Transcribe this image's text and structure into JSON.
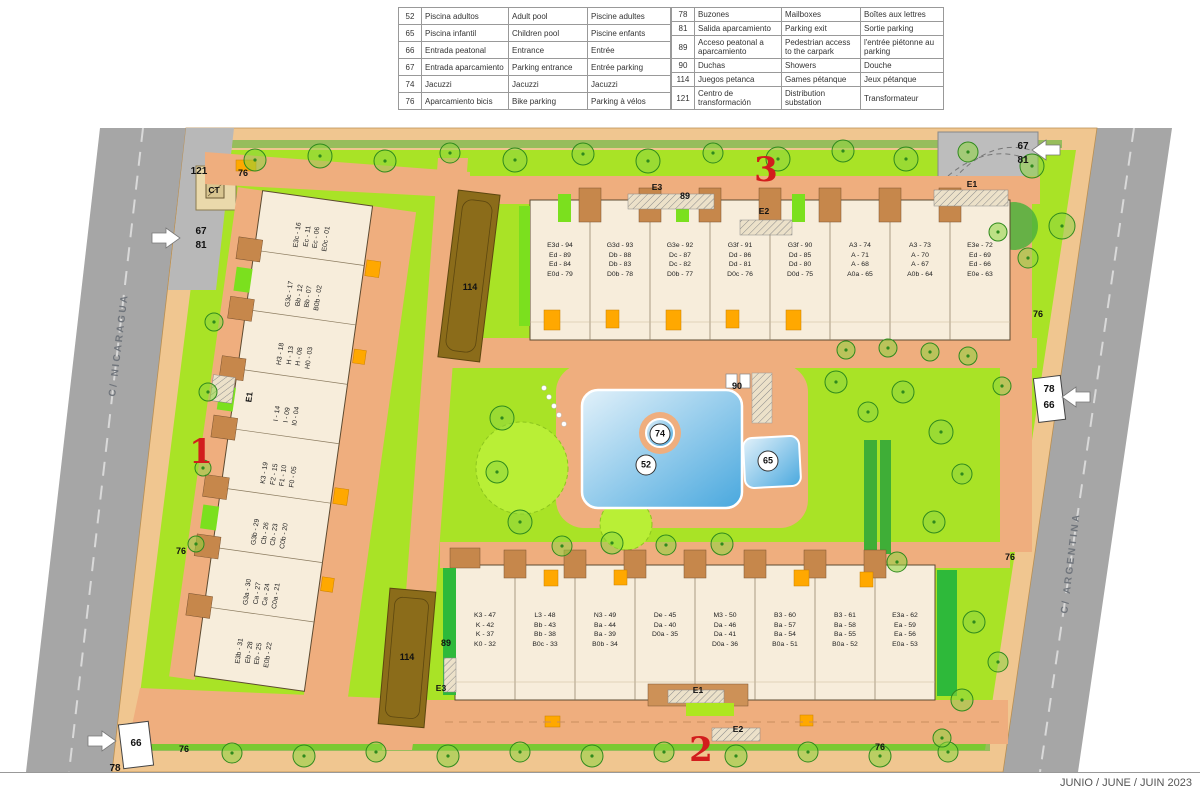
{
  "legend": {
    "rows_left": [
      {
        "num": "52",
        "es": "Piscina adultos",
        "en": "Adult pool",
        "fr": "Piscine adultes"
      },
      {
        "num": "65",
        "es": "Piscina infantil",
        "en": "Children pool",
        "fr": "Piscine enfants"
      },
      {
        "num": "66",
        "es": "Entrada peatonal",
        "en": "Entrance",
        "fr": "Entrée"
      },
      {
        "num": "67",
        "es": "Entrada aparcamiento",
        "en": "Parking entrance",
        "fr": "Entrée parking"
      },
      {
        "num": "74",
        "es": "Jacuzzi",
        "en": "Jacuzzi",
        "fr": "Jacuzzi"
      },
      {
        "num": "76",
        "es": "Aparcamiento bicis",
        "en": "Bike parking",
        "fr": "Parking à vélos"
      }
    ],
    "rows_right": [
      {
        "num": "78",
        "es": "Buzones",
        "en": "Mailboxes",
        "fr": "Boîtes aux lettres"
      },
      {
        "num": "81",
        "es": "Salida aparcamiento",
        "en": "Parking exit",
        "fr": "Sortie parking"
      },
      {
        "num": "89",
        "es": "Acceso peatonal a aparcamiento",
        "en": "Pedestrian access to the carpark",
        "fr": "l'entrée piétonne au parking"
      },
      {
        "num": "90",
        "es": "Duchas",
        "en": "Showers",
        "fr": "Douche"
      },
      {
        "num": "114",
        "es": "Juegos petanca",
        "en": "Games pétanque",
        "fr": "Jeux pétanque"
      },
      {
        "num": "121",
        "es": "Centro de transformación",
        "en": "Distribution substation",
        "fr": "Transformateur"
      }
    ]
  },
  "plan": {
    "streets": {
      "left": "C/ NICARAGUA",
      "right": "C/ ARGENTINA"
    },
    "date_stamp": "JUNIO / JUNE / JUIN 2023",
    "labels": {
      "n52": "52",
      "n65": "65",
      "n66": "66",
      "n67": "67",
      "n74": "74",
      "n76": "76",
      "n78": "78",
      "n81": "81",
      "n89": "89",
      "n90": "90",
      "n114": "114",
      "n121": "121",
      "ct": "CT",
      "e1": "E1",
      "e2": "E2",
      "e3": "E3",
      "block1": "1",
      "block2": "2",
      "block3": "3"
    },
    "buildings": {
      "b1": {
        "units": [
          {
            "l1": "E3c - 16",
            "l2": "Ec - 11",
            "l3": "Ec - 06",
            "l4": "E0c - 01"
          },
          {
            "l1": "G3c - 17",
            "l2": "Bb - 12",
            "l3": "Bb - 07",
            "l4": "B0b - 02"
          },
          {
            "l1": "H3 - 18",
            "l2": "H - 13",
            "l3": "H - 08",
            "l4": "H0 - 03"
          },
          {
            "l1": "I - 14",
            "l2": "I - 09",
            "l3": "I0 - 04"
          },
          {
            "l1": "K3 - 19",
            "l2": "F2 - 15",
            "l3": "F1 - 10",
            "l4": "F0 - 05"
          },
          {
            "l1": "G3b - 29",
            "l2": "Cb - 26",
            "l3": "Cb - 23",
            "l4": "C0b - 20"
          },
          {
            "l1": "G3a - 30",
            "l2": "Ca - 27",
            "l3": "Ca - 24",
            "l4": "C0a - 21"
          },
          {
            "l1": "E3b - 31",
            "l2": "Eb - 28",
            "l3": "Eb - 25",
            "l4": "E0b - 22"
          }
        ]
      },
      "b2": {
        "units": [
          {
            "l1": "K3 - 47",
            "l2": "K - 42",
            "l3": "K - 37",
            "l4": "K0 - 32"
          },
          {
            "l1": "L3 - 48",
            "l2": "Bb - 43",
            "l3": "Bb - 38",
            "l4": "B0c - 33"
          },
          {
            "l1": "N3 - 49",
            "l2": "Ba - 44",
            "l3": "Ba - 39",
            "l4": "B0b - 34"
          },
          {
            "l1": "De - 45",
            "l2": "Da - 40",
            "l3": "D0a - 35"
          },
          {
            "l1": "M3 - 50",
            "l2": "Da - 46",
            "l3": "Da - 41",
            "l4": "D0a - 36"
          },
          {
            "l1": "B3 - 60",
            "l2": "Ba - 57",
            "l3": "Ba - 54",
            "l4": "B0a - 51"
          },
          {
            "l1": "B3 - 61",
            "l2": "Ba - 58",
            "l3": "Ba - 55",
            "l4": "B0a - 52"
          },
          {
            "l1": "E3a - 62",
            "l2": "Ea - 59",
            "l3": "Ea - 56",
            "l4": "E0a - 53"
          }
        ]
      },
      "b3": {
        "units": [
          {
            "l1": "E3d - 94",
            "l2": "Ed - 89",
            "l3": "Ed - 84",
            "l4": "E0d - 79"
          },
          {
            "l1": "G3d - 93",
            "l2": "Db - 88",
            "l3": "Db - 83",
            "l4": "D0b - 78"
          },
          {
            "l1": "G3e - 92",
            "l2": "Dc - 87",
            "l3": "Dc - 82",
            "l4": "D0b - 77"
          },
          {
            "l1": "G3f - 91",
            "l2": "Dd - 86",
            "l3": "Dd - 81",
            "l4": "D0c - 76"
          },
          {
            "l1": "G3f - 90",
            "l2": "Dd - 85",
            "l3": "Dd - 80",
            "l4": "D0d - 75"
          },
          {
            "l1": "A3 - 74",
            "l2": "A - 71",
            "l3": "A - 68",
            "l4": "A0a - 65"
          },
          {
            "l1": "A3 - 73",
            "l2": "A - 70",
            "l3": "A - 67",
            "l4": "A0b - 64"
          },
          {
            "l1": "E3e - 72",
            "l2": "Ed - 69",
            "l3": "Ed - 66",
            "l4": "E0e - 63"
          }
        ]
      }
    }
  },
  "colors": {
    "grass": "#a9e326",
    "path": "#efae7e",
    "road": "#a6a6a6",
    "pool": "#49a8de",
    "building": "#f7eddb",
    "petanque": "#8b6c1a",
    "accent_orange": "#ffa800",
    "marker_red": "#d21d1d"
  }
}
